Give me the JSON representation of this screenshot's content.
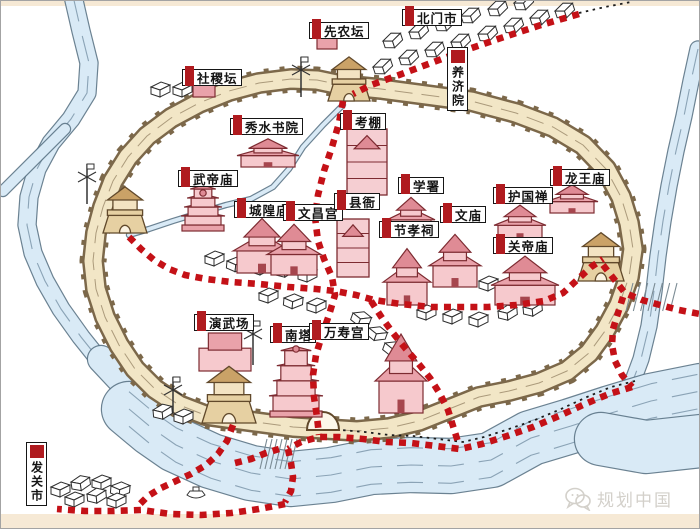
{
  "meta": {
    "watermark": "规划中国"
  },
  "palette": {
    "route_red": "#c41117",
    "label_red": "#b01b1f",
    "wall_fill": "#f2e6c6",
    "wall_edge": "#7c684a",
    "river_fill": "#d9eaf6",
    "river_edge": "#5b7486",
    "flow_line": "#7d97aa",
    "temple_fill": "#f6c9cd",
    "roof_fill": "#e9a2aa",
    "roof_dark": "#df8b95",
    "temple_stroke": "#7d2b31",
    "tower_fill": "#e6d0a2",
    "tower_roof": "#caa267",
    "tower_stroke": "#61492b",
    "house_stroke": "#2e2e2e",
    "strip": "#f6e9d5",
    "text": "#141414"
  },
  "labels": [
    {
      "name": "beimenshi",
      "text": "北门市",
      "x": 401,
      "y": 8,
      "o": "h"
    },
    {
      "name": "xiannongtan",
      "text": "先农坛",
      "x": 308,
      "y": 21,
      "o": "h"
    },
    {
      "name": "yangjiyuan",
      "text": "养济院",
      "x": 446,
      "y": 46,
      "o": "v"
    },
    {
      "name": "shejitan",
      "text": "社稷坛",
      "x": 181,
      "y": 68,
      "o": "h"
    },
    {
      "name": "xiushuishuyuan",
      "text": "秀水书院",
      "x": 229,
      "y": 117,
      "o": "h"
    },
    {
      "name": "kaopeng",
      "text": "考棚",
      "x": 339,
      "y": 112,
      "o": "h"
    },
    {
      "name": "wudimiao",
      "text": "武帝庙",
      "x": 177,
      "y": 169,
      "o": "h"
    },
    {
      "name": "xueshu",
      "text": "学署",
      "x": 397,
      "y": 176,
      "o": "h"
    },
    {
      "name": "longwangmiao",
      "text": "龙王庙",
      "x": 549,
      "y": 168,
      "o": "h"
    },
    {
      "name": "huguochan",
      "text": "护国禅",
      "x": 492,
      "y": 186,
      "o": "h"
    },
    {
      "name": "chenghuangmiao",
      "text": "城隍庙",
      "x": 233,
      "y": 200,
      "o": "h"
    },
    {
      "name": "wenchanggong",
      "text": "文昌宫",
      "x": 282,
      "y": 203,
      "o": "h"
    },
    {
      "name": "xianya",
      "text": "县衙",
      "x": 333,
      "y": 192,
      "o": "h"
    },
    {
      "name": "wenmiao",
      "text": "文庙",
      "x": 439,
      "y": 205,
      "o": "h"
    },
    {
      "name": "jiexiaoci",
      "text": "节孝祠",
      "x": 378,
      "y": 220,
      "o": "h"
    },
    {
      "name": "guandimiao",
      "text": "关帝庙",
      "x": 492,
      "y": 236,
      "o": "h"
    },
    {
      "name": "yanwuchang",
      "text": "演武场",
      "x": 193,
      "y": 313,
      "o": "h"
    },
    {
      "name": "nanta",
      "text": "南塔",
      "x": 269,
      "y": 325,
      "o": "h"
    },
    {
      "name": "wanshougong",
      "text": "万寿宫",
      "x": 308,
      "y": 322,
      "o": "h"
    },
    {
      "name": "faguanshi",
      "text": "发关市",
      "x": 25,
      "y": 441,
      "o": "v"
    }
  ],
  "redRoutes": [
    [
      [
        578,
        13
      ],
      [
        540,
        24
      ],
      [
        500,
        37
      ],
      [
        462,
        50
      ],
      [
        430,
        62
      ],
      [
        398,
        74
      ],
      [
        370,
        84
      ],
      [
        352,
        93
      ]
    ],
    [
      [
        342,
        100
      ],
      [
        338,
        122
      ],
      [
        331,
        146
      ],
      [
        323,
        170
      ],
      [
        317,
        194
      ],
      [
        314,
        216
      ],
      [
        317,
        240
      ],
      [
        323,
        258
      ],
      [
        331,
        276
      ],
      [
        334,
        294
      ],
      [
        328,
        314
      ],
      [
        321,
        334
      ],
      [
        315,
        354
      ],
      [
        312,
        374
      ],
      [
        313,
        396
      ],
      [
        316,
        416
      ],
      [
        318,
        434
      ]
    ],
    [
      [
        128,
        236
      ],
      [
        140,
        248
      ],
      [
        153,
        259
      ],
      [
        168,
        268
      ],
      [
        184,
        274
      ],
      [
        205,
        278
      ],
      [
        230,
        281
      ],
      [
        258,
        283
      ],
      [
        288,
        286
      ],
      [
        315,
        288
      ],
      [
        334,
        290
      ],
      [
        355,
        294
      ],
      [
        373,
        299
      ],
      [
        400,
        303
      ],
      [
        430,
        306
      ],
      [
        458,
        306
      ],
      [
        487,
        306
      ],
      [
        515,
        304
      ],
      [
        543,
        300
      ],
      [
        562,
        292
      ],
      [
        576,
        279
      ],
      [
        590,
        266
      ],
      [
        602,
        258
      ]
    ],
    [
      [
        602,
        264
      ],
      [
        613,
        278
      ],
      [
        624,
        292
      ],
      [
        641,
        299
      ],
      [
        659,
        304
      ],
      [
        678,
        309
      ],
      [
        699,
        313
      ]
    ],
    [
      [
        622,
        296
      ],
      [
        617,
        312
      ],
      [
        612,
        328
      ],
      [
        611,
        344
      ],
      [
        614,
        360
      ],
      [
        621,
        374
      ],
      [
        631,
        386
      ]
    ],
    [
      [
        631,
        386
      ],
      [
        608,
        393
      ],
      [
        584,
        403
      ],
      [
        558,
        415
      ],
      [
        532,
        426
      ],
      [
        506,
        435
      ],
      [
        481,
        443
      ],
      [
        459,
        448
      ],
      [
        435,
        445
      ],
      [
        410,
        442
      ],
      [
        386,
        441
      ],
      [
        362,
        438
      ],
      [
        338,
        436
      ],
      [
        318,
        436
      ],
      [
        300,
        441
      ],
      [
        287,
        448
      ]
    ],
    [
      [
        287,
        448
      ],
      [
        290,
        462
      ],
      [
        292,
        476
      ],
      [
        290,
        490
      ],
      [
        284,
        501
      ]
    ],
    [
      [
        284,
        503
      ],
      [
        258,
        508
      ],
      [
        230,
        512
      ],
      [
        200,
        514
      ],
      [
        170,
        513
      ],
      [
        140,
        509
      ],
      [
        112,
        510
      ],
      [
        84,
        510
      ],
      [
        56,
        508
      ]
    ],
    [
      [
        232,
        424
      ],
      [
        226,
        440
      ],
      [
        217,
        453
      ],
      [
        205,
        464
      ],
      [
        190,
        473
      ],
      [
        175,
        480
      ],
      [
        160,
        487
      ],
      [
        147,
        495
      ],
      [
        138,
        504
      ]
    ],
    [
      [
        234,
        462
      ],
      [
        250,
        458
      ],
      [
        265,
        452
      ],
      [
        278,
        448
      ]
    ],
    [
      [
        370,
        300
      ],
      [
        381,
        317
      ],
      [
        392,
        332
      ],
      [
        404,
        347
      ],
      [
        417,
        362
      ],
      [
        429,
        377
      ],
      [
        439,
        393
      ],
      [
        447,
        409
      ],
      [
        452,
        425
      ],
      [
        457,
        441
      ]
    ]
  ],
  "blackTrails": [
    [
      [
        578,
        12
      ],
      [
        604,
        6
      ],
      [
        630,
        1
      ]
    ],
    [
      [
        634,
        380
      ],
      [
        610,
        386
      ],
      [
        586,
        396
      ],
      [
        560,
        408
      ],
      [
        534,
        419
      ],
      [
        508,
        428
      ],
      [
        483,
        436
      ],
      [
        462,
        441
      ],
      [
        437,
        438
      ],
      [
        412,
        435
      ],
      [
        388,
        434
      ],
      [
        364,
        431
      ],
      [
        340,
        429
      ]
    ]
  ],
  "rivers": [
    {
      "pts": [
        [
          72,
          -5
        ],
        [
          80,
          30
        ],
        [
          88,
          62
        ],
        [
          86,
          92
        ],
        [
          70,
          118
        ],
        [
          50,
          142
        ],
        [
          36,
          168
        ],
        [
          28,
          196
        ],
        [
          26,
          224
        ],
        [
          32,
          252
        ],
        [
          44,
          280
        ],
        [
          60,
          308
        ],
        [
          80,
          336
        ],
        [
          104,
          366
        ],
        [
          132,
          396
        ],
        [
          160,
          422
        ],
        [
          186,
          442
        ]
      ],
      "w": 17,
      "flow": 1
    },
    {
      "pts": [
        [
          64,
          128
        ],
        [
          42,
          150
        ],
        [
          20,
          172
        ],
        [
          2,
          190
        ]
      ],
      "w": 10,
      "flow": 0
    },
    {
      "pts": [
        [
          100,
          358
        ],
        [
          130,
          390
        ],
        [
          158,
          416
        ],
        [
          186,
          440
        ]
      ],
      "w": 26,
      "flow": 0
    },
    {
      "pts": [
        [
          697,
          48
        ],
        [
          690,
          80
        ],
        [
          683,
          115
        ],
        [
          675,
          150
        ],
        [
          668,
          185
        ],
        [
          662,
          220
        ],
        [
          657,
          255
        ],
        [
          653,
          290
        ],
        [
          648,
          325
        ],
        [
          640,
          358
        ],
        [
          630,
          385
        ]
      ],
      "w": 15,
      "flow": 1
    },
    {
      "pts": [
        [
          128,
          408
        ],
        [
          152,
          428
        ],
        [
          175,
          444
        ],
        [
          210,
          460
        ],
        [
          250,
          472
        ],
        [
          290,
          478
        ],
        [
          330,
          474
        ],
        [
          370,
          466
        ],
        [
          410,
          464
        ],
        [
          450,
          465
        ],
        [
          490,
          459
        ],
        [
          530,
          437
        ],
        [
          570,
          425
        ],
        [
          610,
          412
        ],
        [
          650,
          400
        ],
        [
          700,
          390
        ]
      ],
      "w": 54,
      "flow": 3
    },
    {
      "pts": [
        [
          600,
          438
        ],
        [
          645,
          446
        ],
        [
          700,
          440
        ]
      ],
      "w": 52,
      "flow": 0
    },
    {
      "pts": [
        [
          342,
          104
        ],
        [
          322,
          124
        ],
        [
          302,
          146
        ],
        [
          288,
          168
        ],
        [
          272,
          186
        ],
        [
          250,
          198
        ],
        [
          225,
          204
        ],
        [
          198,
          212
        ],
        [
          172,
          220
        ],
        [
          148,
          228
        ],
        [
          128,
          234
        ]
      ],
      "w": 4,
      "flow": 0
    }
  ],
  "wall": {
    "ring": [
      [
        340,
        84
      ],
      [
        380,
        88
      ],
      [
        425,
        94
      ],
      [
        470,
        100
      ],
      [
        515,
        112
      ],
      [
        552,
        126
      ],
      [
        582,
        144
      ],
      [
        605,
        168
      ],
      [
        620,
        196
      ],
      [
        628,
        222
      ],
      [
        632,
        248
      ],
      [
        628,
        276
      ],
      [
        618,
        304
      ],
      [
        604,
        330
      ],
      [
        588,
        352
      ],
      [
        566,
        370
      ],
      [
        538,
        382
      ],
      [
        508,
        390
      ],
      [
        478,
        396
      ],
      [
        448,
        408
      ],
      [
        418,
        420
      ],
      [
        388,
        427
      ],
      [
        356,
        430
      ],
      [
        324,
        428
      ],
      [
        292,
        426
      ],
      [
        262,
        422
      ],
      [
        232,
        418
      ],
      [
        204,
        414
      ],
      [
        178,
        404
      ],
      [
        154,
        388
      ],
      [
        134,
        368
      ],
      [
        118,
        344
      ],
      [
        104,
        316
      ],
      [
        95,
        288
      ],
      [
        92,
        260
      ],
      [
        95,
        232
      ],
      [
        102,
        206
      ],
      [
        112,
        180
      ],
      [
        127,
        156
      ],
      [
        146,
        135
      ],
      [
        170,
        117
      ],
      [
        198,
        102
      ],
      [
        228,
        90
      ],
      [
        258,
        82
      ],
      [
        290,
        78
      ],
      [
        316,
        79
      ],
      [
        340,
        84
      ]
    ],
    "arch": {
      "x1": 306,
      "x2": 338,
      "y": 429
    }
  },
  "towers": [
    {
      "x": 348,
      "y": 100,
      "s": 1.05
    },
    {
      "x": 124,
      "y": 232,
      "s": 1.1
    },
    {
      "x": 600,
      "y": 280,
      "s": 1.15
    },
    {
      "x": 228,
      "y": 422,
      "s": 1.35
    }
  ],
  "temples": [
    {
      "x": 346,
      "y": 128,
      "w": 40,
      "h": 66,
      "k": "compound"
    },
    {
      "x": 240,
      "y": 136,
      "w": 54,
      "h": 30,
      "k": "temple"
    },
    {
      "x": 184,
      "y": 186,
      "w": 36,
      "h": 44,
      "k": "pagoda"
    },
    {
      "x": 236,
      "y": 214,
      "w": 50,
      "h": 58,
      "k": "temple"
    },
    {
      "x": 270,
      "y": 220,
      "w": 46,
      "h": 54,
      "k": "temple"
    },
    {
      "x": 336,
      "y": 218,
      "w": 32,
      "h": 58,
      "k": "compound"
    },
    {
      "x": 390,
      "y": 194,
      "w": 40,
      "h": 40,
      "k": "temple"
    },
    {
      "x": 432,
      "y": 230,
      "w": 44,
      "h": 56,
      "k": "temple"
    },
    {
      "x": 386,
      "y": 244,
      "w": 40,
      "h": 60,
      "k": "temple"
    },
    {
      "x": 497,
      "y": 202,
      "w": 44,
      "h": 36,
      "k": "temple"
    },
    {
      "x": 549,
      "y": 182,
      "w": 44,
      "h": 30,
      "k": "temple"
    },
    {
      "x": 494,
      "y": 252,
      "w": 60,
      "h": 52,
      "k": "temple"
    },
    {
      "x": 198,
      "y": 332,
      "w": 52,
      "h": 38,
      "k": "platform"
    },
    {
      "x": 378,
      "y": 328,
      "w": 44,
      "h": 84,
      "k": "temple"
    },
    {
      "x": 272,
      "y": 342,
      "w": 46,
      "h": 74,
      "k": "pagoda"
    },
    {
      "x": 316,
      "y": 34,
      "w": 20,
      "h": 14,
      "k": "altar"
    },
    {
      "x": 192,
      "y": 84,
      "w": 22,
      "h": 12,
      "k": "altar"
    }
  ],
  "houses": [
    [
      382,
      40,
      -18
    ],
    [
      408,
      31,
      -18
    ],
    [
      434,
      23,
      -18
    ],
    [
      460,
      15,
      -18
    ],
    [
      487,
      8,
      -18
    ],
    [
      513,
      2,
      -18
    ],
    [
      372,
      66,
      -18
    ],
    [
      398,
      57,
      -18
    ],
    [
      424,
      49,
      -18
    ],
    [
      450,
      41,
      -18
    ],
    [
      477,
      33,
      -18
    ],
    [
      503,
      25,
      -18
    ],
    [
      529,
      17,
      -18
    ],
    [
      554,
      10,
      -18
    ],
    [
      204,
      255,
      0
    ],
    [
      226,
      260,
      5
    ],
    [
      250,
      264,
      0
    ],
    [
      274,
      267,
      -5
    ],
    [
      297,
      271,
      0
    ],
    [
      258,
      292,
      0
    ],
    [
      283,
      297,
      5
    ],
    [
      306,
      302,
      0
    ],
    [
      352,
      312,
      20
    ],
    [
      368,
      327,
      20
    ],
    [
      384,
      342,
      20
    ],
    [
      416,
      309,
      0
    ],
    [
      442,
      313,
      0
    ],
    [
      468,
      316,
      0
    ],
    [
      497,
      310,
      -5
    ],
    [
      522,
      306,
      -5
    ],
    [
      478,
      280,
      0
    ],
    [
      501,
      285,
      0
    ],
    [
      524,
      288,
      0
    ],
    [
      50,
      486,
      0
    ],
    [
      70,
      481,
      -8
    ],
    [
      91,
      479,
      0
    ],
    [
      110,
      485,
      5
    ],
    [
      64,
      496,
      0
    ],
    [
      86,
      493,
      -5
    ],
    [
      106,
      497,
      0
    ],
    [
      152,
      409,
      -5
    ],
    [
      173,
      413,
      0
    ],
    [
      172,
      86,
      0
    ],
    [
      150,
      86,
      0
    ]
  ],
  "poles": [
    [
      300,
      56,
      40
    ],
    [
      252,
      320,
      44
    ],
    [
      172,
      376,
      36
    ],
    [
      86,
      163,
      40
    ]
  ],
  "boat": {
    "x": 186,
    "y": 490
  },
  "fords": [
    {
      "x": 266,
      "y": 438,
      "w": 30,
      "h": 30
    },
    {
      "x": 632,
      "y": 282,
      "w": 44,
      "h": 28
    }
  ]
}
